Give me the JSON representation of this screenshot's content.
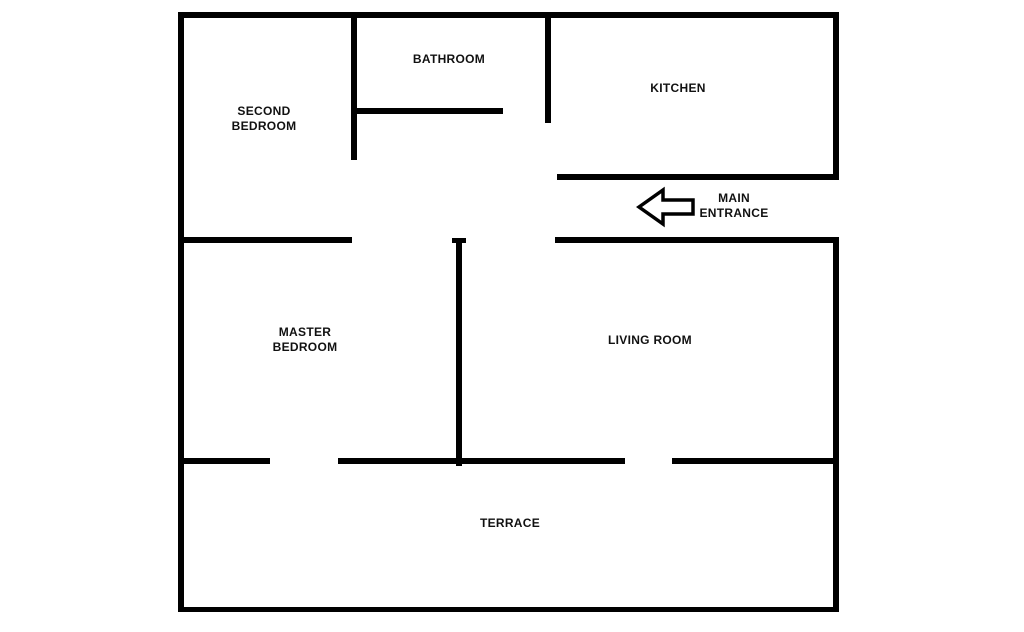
{
  "diagram": {
    "type": "apartment-floor-plan",
    "rooms": {
      "second_bedroom": {
        "label": "SECOND BEDROOM"
      },
      "bathroom": {
        "label": "BATHROOM"
      },
      "kitchen": {
        "label": "KITCHEN"
      },
      "master_bedroom": {
        "label": "MASTER BEDROOM"
      },
      "living_room": {
        "label": "LIVING ROOM"
      },
      "terrace": {
        "label": "TERRACE"
      }
    },
    "entrance": {
      "label": "MAIN ENTRANCE",
      "arrow_direction": "left"
    },
    "colors": {
      "wall": "#000000",
      "background": "#ffffff",
      "text": "#111111"
    }
  }
}
